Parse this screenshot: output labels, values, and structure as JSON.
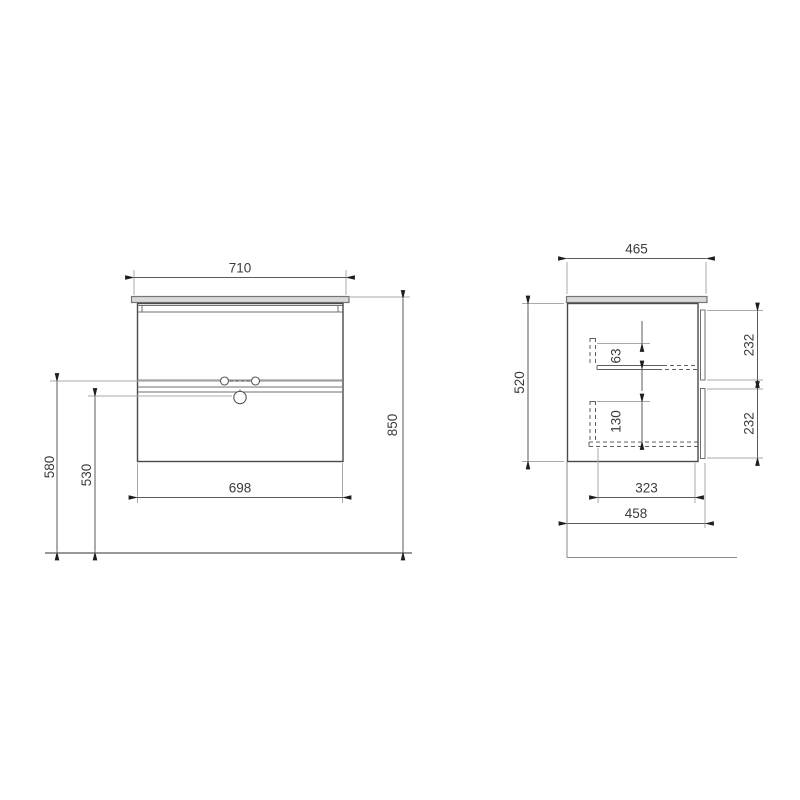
{
  "title": "vanity-cabinet-technical-drawing",
  "colors": {
    "background": "#ffffff",
    "object_line": "#4a4a4a",
    "dimension_line": "#5a5a5a",
    "extension_line": "#a9a9a9",
    "countertop_fill": "#d9d9d9",
    "text": "#3b3b3b"
  },
  "front_view": {
    "dims": {
      "top_width": "710",
      "overall_height": "850",
      "tap_holes_height": "580",
      "drain_hole_height": "530",
      "cabinet_width": "698"
    }
  },
  "side_view": {
    "dims": {
      "top_depth": "465",
      "carcass_height": "520",
      "upper_drawer_inner": "63",
      "upper_drawer_front_height": "232",
      "lower_drawer_inner": "130",
      "lower_drawer_front_height": "232",
      "drawer_inner_depth": "323",
      "carcass_depth": "458"
    }
  }
}
